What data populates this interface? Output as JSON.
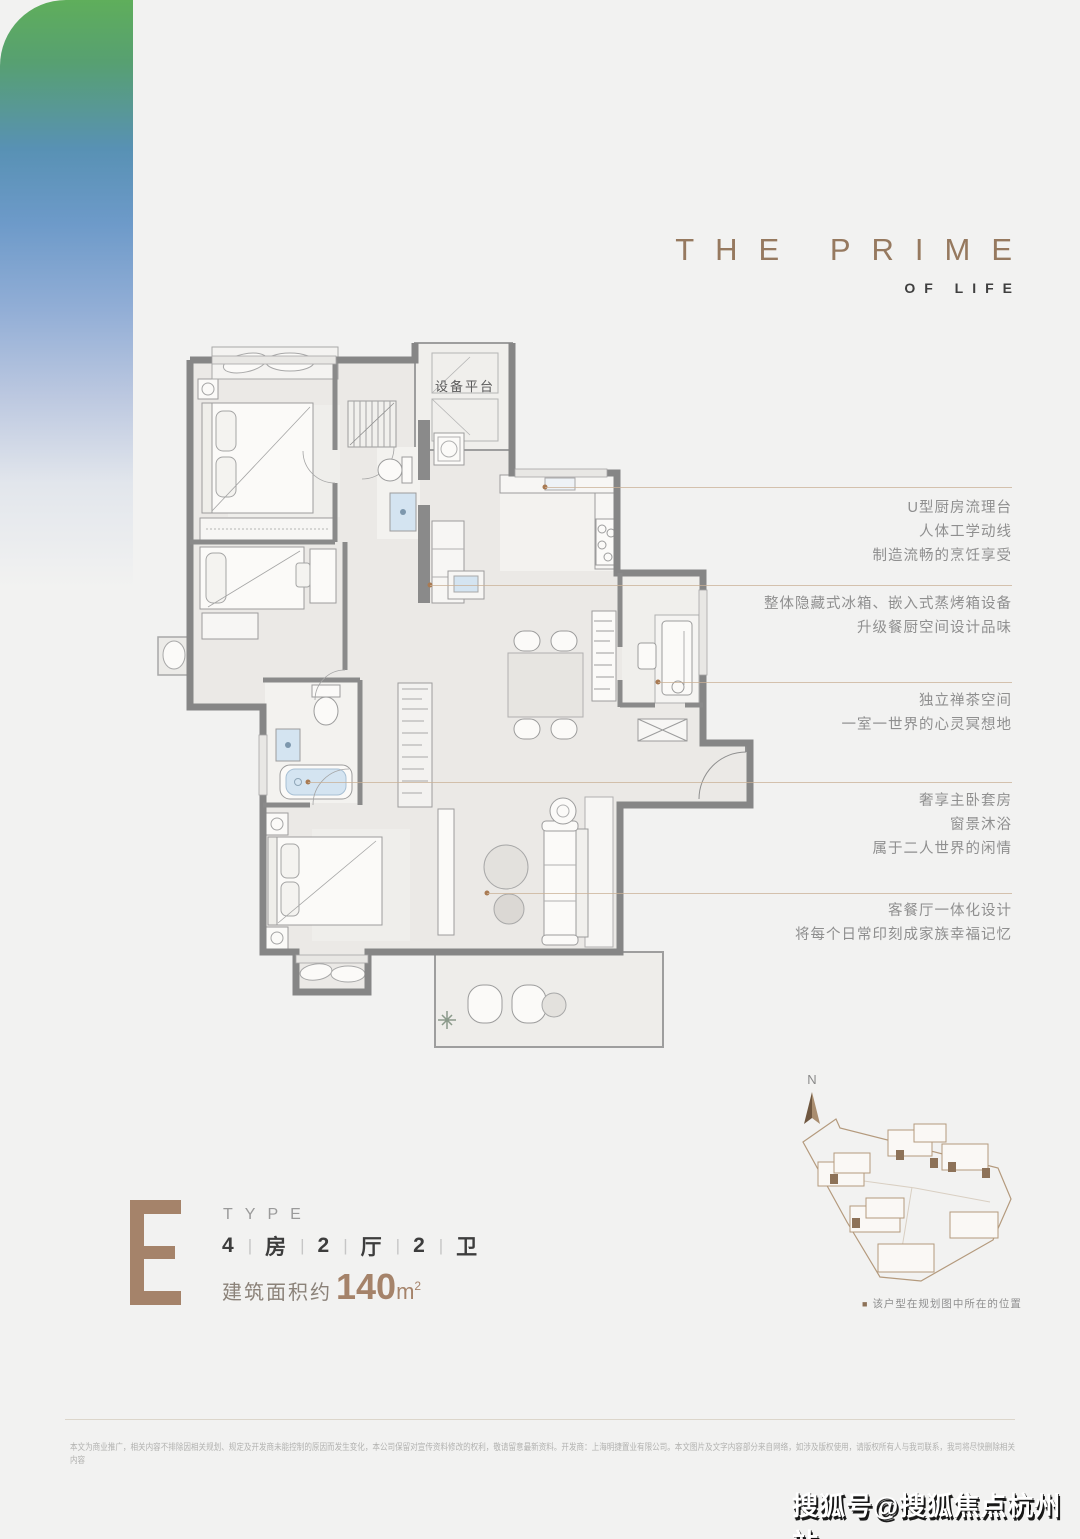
{
  "brand": {
    "title_line1": "THE PRIME",
    "title_line2": "OF LIFE"
  },
  "floor_plan": {
    "equipment_platform_label": "设备平台"
  },
  "annotations": [
    {
      "id": "kitchen",
      "lines": [
        "U型厨房流理台",
        "人体工学动线",
        "制造流畅的烹饪享受"
      ]
    },
    {
      "id": "fridge",
      "lines": [
        "整体隐藏式冰箱、嵌入式蒸烤箱设备",
        "升级餐厨空间设计品味"
      ]
    },
    {
      "id": "tea-room",
      "lines": [
        "独立禅茶空间",
        "一室一世界的心灵冥想地"
      ]
    },
    {
      "id": "master",
      "lines": [
        "奢享主卧套房",
        "窗景沐浴",
        "属于二人世界的闲情"
      ]
    },
    {
      "id": "living",
      "lines": [
        "客餐厅一体化设计",
        "将每个日常印刻成家族幸福记忆"
      ]
    }
  ],
  "type_info": {
    "letter": "E",
    "type_label": "TYPE",
    "layout_parts": [
      "4",
      "房",
      "2",
      "厅",
      "2",
      "卫"
    ],
    "separator": "|",
    "area_prefix": "建筑面积约",
    "area_value": "140",
    "area_unit": "m",
    "area_sup": "2"
  },
  "site_plan": {
    "north_label": "N",
    "caption_marker": "■",
    "caption": "该户型在规划图中所在的位置"
  },
  "disclaimer": "本文为商业推广，相关内容不排除因相关规划、规定及开发商未能控制的原因而发生变化，本公司保留对宣传资料修改的权利，敬请留意最新资料。开发商：上海明捷置业有限公司。本文图片及文字内容部分来自网络，如涉及版权使用，请版权所有人与我司联系，我司将尽快删除相关内容",
  "watermark": "搜狐号@搜狐焦点杭州站",
  "colors": {
    "accent_brown": "#a5836a",
    "title_brown": "#96795f",
    "wall_gray": "#868686",
    "leader_tan": "#c9b096",
    "gradient_green": "#5fae5b",
    "gradient_blue": "#5891b4",
    "bath_blue": "#d4e4f1",
    "site_line": "#b49a7d"
  }
}
